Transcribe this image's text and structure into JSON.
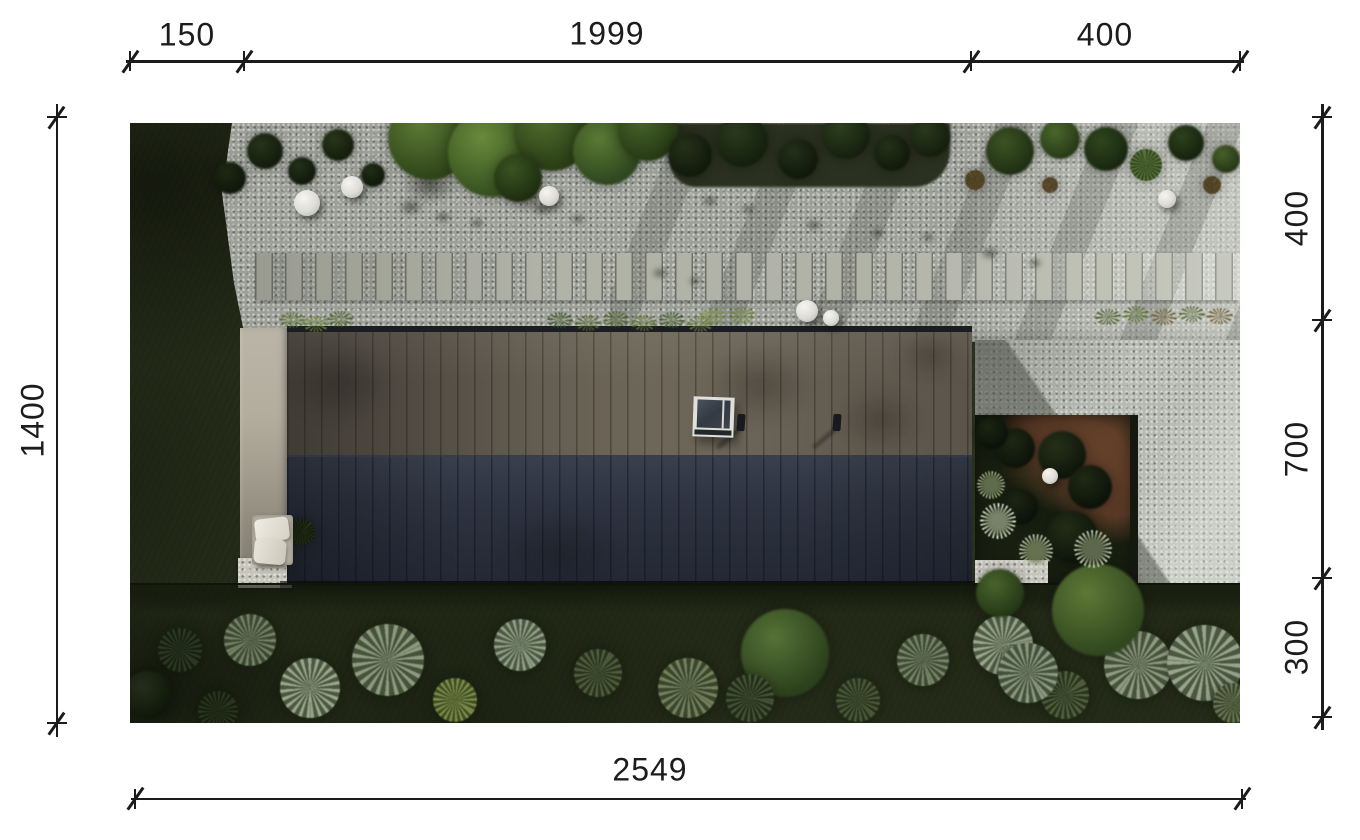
{
  "figure": {
    "type": "architectural-site-plan",
    "description": "top-down aerial rendering of an elongated flat-roof house with gravel path, stepping stones, driveway, courtyard and garden"
  },
  "dimensions": {
    "top": {
      "segments": [
        {
          "label": "150"
        },
        {
          "label": "1999"
        },
        {
          "label": "400"
        }
      ]
    },
    "left": {
      "segments": [
        {
          "label": "1400"
        }
      ]
    },
    "right": {
      "segments": [
        {
          "label": "400"
        },
        {
          "label": "700"
        },
        {
          "label": "300"
        }
      ]
    },
    "bottom": {
      "segments": [
        {
          "label": "2549"
        }
      ]
    }
  },
  "colors": {
    "dimension_ink": "#1b1b1b",
    "page_background": "#ffffff",
    "roof_upper": "#655e52",
    "roof_lower": "#2a303d",
    "gravel": "#9da099",
    "driveway": "#b7bab3",
    "grass_dark": "#2a311c",
    "terrace": "#aba592",
    "courtyard_soil": "#63402a"
  },
  "scene": {
    "lamps": [
      {
        "x": 177,
        "y": 80,
        "r": 13
      },
      {
        "x": 222,
        "y": 64,
        "r": 11
      },
      {
        "x": 419,
        "y": 73,
        "r": 10
      },
      {
        "x": 677,
        "y": 188,
        "r": 11
      },
      {
        "x": 701,
        "y": 195,
        "r": 8
      },
      {
        "x": 1037,
        "y": 76,
        "r": 9
      },
      {
        "x": 920,
        "y": 353,
        "r": 8
      }
    ],
    "greens_top": [
      {
        "x": 300,
        "y": 15,
        "r": 42,
        "c1": "#5d7b35",
        "c2": "#2f4419"
      },
      {
        "x": 362,
        "y": 30,
        "r": 44,
        "c1": "#688a3c",
        "c2": "#36511f"
      },
      {
        "x": 422,
        "y": 10,
        "r": 38,
        "c1": "#4f6c2c",
        "c2": "#2a3d16"
      },
      {
        "x": 477,
        "y": 28,
        "r": 34,
        "c1": "#5a7a33",
        "c2": "#2f4620"
      },
      {
        "x": 518,
        "y": 8,
        "r": 30,
        "c1": "#47632a",
        "c2": "#273a15"
      },
      {
        "x": 388,
        "y": 55,
        "r": 24,
        "c1": "#3a5322",
        "c2": "#1e2d10"
      },
      {
        "x": 135,
        "y": 28,
        "r": 18,
        "c1": "#26331a",
        "c2": "#121b0c"
      },
      {
        "x": 172,
        "y": 48,
        "r": 14,
        "c1": "#22301a",
        "c2": "#10180a"
      },
      {
        "x": 208,
        "y": 22,
        "r": 16,
        "c1": "#283619",
        "c2": "#131c0c"
      },
      {
        "x": 243,
        "y": 52,
        "r": 12,
        "c1": "#202e16",
        "c2": "#101809"
      },
      {
        "x": 100,
        "y": 55,
        "r": 16,
        "c1": "#1d2913",
        "c2": "#0e160a"
      },
      {
        "x": 560,
        "y": 32,
        "r": 22,
        "c1": "#243119",
        "c2": "#11190b"
      },
      {
        "x": 612,
        "y": 18,
        "r": 26,
        "c1": "#2a3a1d",
        "c2": "#141f0d"
      },
      {
        "x": 668,
        "y": 36,
        "r": 20,
        "c1": "#22301a",
        "c2": "#10180a"
      },
      {
        "x": 716,
        "y": 12,
        "r": 24,
        "c1": "#2d3f1e",
        "c2": "#15200e"
      },
      {
        "x": 762,
        "y": 30,
        "r": 18,
        "c1": "#243218",
        "c2": "#11190b"
      },
      {
        "x": 800,
        "y": 14,
        "r": 20,
        "c1": "#2a3a1c",
        "c2": "#141e0d"
      },
      {
        "x": 880,
        "y": 28,
        "r": 24,
        "c1": "#3c5323",
        "c2": "#1f2f13"
      },
      {
        "x": 930,
        "y": 16,
        "r": 20,
        "c1": "#4a662c",
        "c2": "#273a17"
      },
      {
        "x": 976,
        "y": 26,
        "r": 22,
        "c1": "#2f451d",
        "c2": "#18270f"
      },
      {
        "x": 1016,
        "y": 42,
        "r": 16,
        "c1": "#5b7539",
        "c2": "#31451f",
        "t": "spiky"
      },
      {
        "x": 1056,
        "y": 20,
        "r": 18,
        "c1": "#2c411c",
        "c2": "#15220e"
      },
      {
        "x": 1096,
        "y": 36,
        "r": 14,
        "c1": "#47602b",
        "c2": "#253615"
      },
      {
        "x": 845,
        "y": 57,
        "r": 10,
        "c1": "#6a5c34",
        "c2": "#3a3119",
        "t": "spiky"
      },
      {
        "x": 920,
        "y": 62,
        "r": 8,
        "c1": "#73603a",
        "c2": "#40331d",
        "t": "spiky"
      },
      {
        "x": 1082,
        "y": 62,
        "r": 9,
        "c1": "#6e5f36",
        "c2": "#3c321b",
        "t": "spiky"
      }
    ],
    "gravel_shadows": [
      {
        "x": 281,
        "y": 84,
        "r": 14
      },
      {
        "x": 313,
        "y": 94,
        "r": 10
      },
      {
        "x": 347,
        "y": 100,
        "r": 9
      },
      {
        "x": 412,
        "y": 86,
        "r": 12
      },
      {
        "x": 448,
        "y": 96,
        "r": 9
      },
      {
        "x": 300,
        "y": 62,
        "r": 30
      },
      {
        "x": 398,
        "y": 72,
        "r": 26
      },
      {
        "x": 580,
        "y": 78,
        "r": 10
      },
      {
        "x": 618,
        "y": 86,
        "r": 8
      },
      {
        "x": 684,
        "y": 102,
        "r": 10
      },
      {
        "x": 748,
        "y": 110,
        "r": 9
      },
      {
        "x": 798,
        "y": 114,
        "r": 8
      },
      {
        "x": 860,
        "y": 130,
        "r": 12
      },
      {
        "x": 905,
        "y": 140,
        "r": 9
      },
      {
        "x": 530,
        "y": 150,
        "r": 10
      },
      {
        "x": 565,
        "y": 158,
        "r": 8
      }
    ],
    "roof_blobs": [
      {
        "x": 630,
        "y": 262,
        "r": 55
      },
      {
        "x": 750,
        "y": 297,
        "r": 45
      },
      {
        "x": 800,
        "y": 232,
        "r": 35
      },
      {
        "x": 210,
        "y": 260,
        "r": 55
      },
      {
        "x": 430,
        "y": 430,
        "r": 60
      }
    ],
    "bed_bushes": [
      {
        "x": 885,
        "y": 325,
        "r": 20,
        "c1": "#202a15",
        "c2": "#0d130a"
      },
      {
        "x": 932,
        "y": 332,
        "r": 24,
        "c1": "#243018",
        "c2": "#10170b"
      },
      {
        "x": 960,
        "y": 364,
        "r": 22,
        "c1": "#1f2a14",
        "c2": "#0c120a"
      },
      {
        "x": 890,
        "y": 384,
        "r": 18,
        "c1": "#1c2613",
        "c2": "#0b110a"
      },
      {
        "x": 942,
        "y": 414,
        "r": 26,
        "c1": "#222d15",
        "c2": "#0e140b"
      },
      {
        "x": 862,
        "y": 310,
        "r": 16,
        "c1": "#1b2512",
        "c2": "#0b1109"
      }
    ],
    "flowers": [
      {
        "x": 868,
        "y": 398,
        "r": 18,
        "c1": "#d2d8c2",
        "c2": "#77826a"
      },
      {
        "x": 906,
        "y": 428,
        "r": 17,
        "c1": "#c6cdb4",
        "c2": "#66724f"
      },
      {
        "x": 963,
        "y": 426,
        "r": 19,
        "c1": "#bcc7aa",
        "c2": "#5c684b"
      },
      {
        "x": 861,
        "y": 362,
        "r": 14,
        "c1": "#b2c095",
        "c2": "#5f6d4c"
      }
    ],
    "bushes_bottom": [
      {
        "x": 50,
        "y": 527,
        "r": 22,
        "c1": "#2e3a25",
        "c2": "#161f0f",
        "t": "spiky"
      },
      {
        "x": 120,
        "y": 517,
        "r": 26,
        "c1": "#76836a",
        "c2": "#3c4931",
        "t": "spiky"
      },
      {
        "x": 180,
        "y": 565,
        "r": 30,
        "c1": "#9aa68e",
        "c2": "#4b5840",
        "t": "spiky"
      },
      {
        "x": 258,
        "y": 537,
        "r": 36,
        "c1": "#8d9a7e",
        "c2": "#46533b",
        "t": "spiky"
      },
      {
        "x": 325,
        "y": 577,
        "r": 22,
        "c1": "#7e8e4e",
        "c2": "#414e22",
        "t": "spiky"
      },
      {
        "x": 390,
        "y": 522,
        "r": 26,
        "c1": "#93a089",
        "c2": "#4c5942",
        "t": "spiky"
      },
      {
        "x": 468,
        "y": 550,
        "r": 24,
        "c1": "#515f3d",
        "c2": "#28331d",
        "t": "spiky"
      },
      {
        "x": 558,
        "y": 565,
        "r": 30,
        "c1": "#73805e",
        "c2": "#3a462c",
        "t": "spiky"
      },
      {
        "x": 655,
        "y": 530,
        "r": 44,
        "c1": "#567238",
        "c2": "#2b401b"
      },
      {
        "x": 620,
        "y": 575,
        "r": 24,
        "c1": "#45543a",
        "c2": "#222d18",
        "t": "spiky"
      },
      {
        "x": 728,
        "y": 577,
        "r": 22,
        "c1": "#4e5c38",
        "c2": "#27321e",
        "t": "spiky"
      },
      {
        "x": 793,
        "y": 537,
        "r": 26,
        "c1": "#78866a",
        "c2": "#3e4b33",
        "t": "spiky"
      },
      {
        "x": 873,
        "y": 522,
        "r": 30,
        "c1": "#9ba78d",
        "c2": "#4f5c46",
        "t": "spiky"
      },
      {
        "x": 935,
        "y": 572,
        "r": 24,
        "c1": "#54623e",
        "c2": "#2a3520",
        "t": "spiky"
      },
      {
        "x": 1008,
        "y": 542,
        "r": 34,
        "c1": "#8f9c82",
        "c2": "#48553d",
        "t": "spiky"
      },
      {
        "x": 1075,
        "y": 540,
        "r": 38,
        "c1": "#97a48b",
        "c2": "#4a5741",
        "t": "spiky"
      },
      {
        "x": 1103,
        "y": 580,
        "r": 20,
        "c1": "#6d7b58",
        "c2": "#37422a",
        "t": "spiky"
      },
      {
        "x": 968,
        "y": 487,
        "r": 46,
        "c1": "#5d7836",
        "c2": "#31471e"
      },
      {
        "x": 870,
        "y": 470,
        "r": 24,
        "c1": "#49632c",
        "c2": "#253816"
      },
      {
        "x": 898,
        "y": 550,
        "r": 30,
        "c1": "#8b9880",
        "c2": "#44513c",
        "t": "spiky"
      },
      {
        "x": 18,
        "y": 572,
        "r": 24,
        "c1": "#242e1b",
        "c2": "#10170a"
      },
      {
        "x": 88,
        "y": 588,
        "r": 20,
        "c1": "#2c3720",
        "c2": "#141d0d",
        "t": "spiky"
      },
      {
        "x": 172,
        "y": 409,
        "r": 13,
        "c1": "#2a3318",
        "c2": "#0f150a",
        "t": "spiky"
      }
    ],
    "tufts": [
      {
        "x": 162,
        "y": 197,
        "c": "#57702e"
      },
      {
        "x": 186,
        "y": 201,
        "c": "#6d8338"
      },
      {
        "x": 210,
        "y": 196,
        "c": "#4a6428"
      },
      {
        "x": 430,
        "y": 197,
        "c": "#3e5426"
      },
      {
        "x": 458,
        "y": 200,
        "c": "#56692f"
      },
      {
        "x": 486,
        "y": 196,
        "c": "#49602a"
      },
      {
        "x": 514,
        "y": 200,
        "c": "#5e7233"
      },
      {
        "x": 542,
        "y": 197,
        "c": "#435a26"
      },
      {
        "x": 570,
        "y": 201,
        "c": "#67793a"
      },
      {
        "x": 582,
        "y": 193,
        "c": "#7d9141"
      },
      {
        "x": 612,
        "y": 192,
        "c": "#6d8338"
      },
      {
        "x": 978,
        "y": 194,
        "c": "#4c6329"
      },
      {
        "x": 1006,
        "y": 191,
        "c": "#5a7030"
      },
      {
        "x": 1034,
        "y": 194,
        "c": "#6b5e32"
      },
      {
        "x": 1062,
        "y": 191,
        "c": "#56692f"
      },
      {
        "x": 1090,
        "y": 193,
        "c": "#705f33"
      }
    ]
  }
}
